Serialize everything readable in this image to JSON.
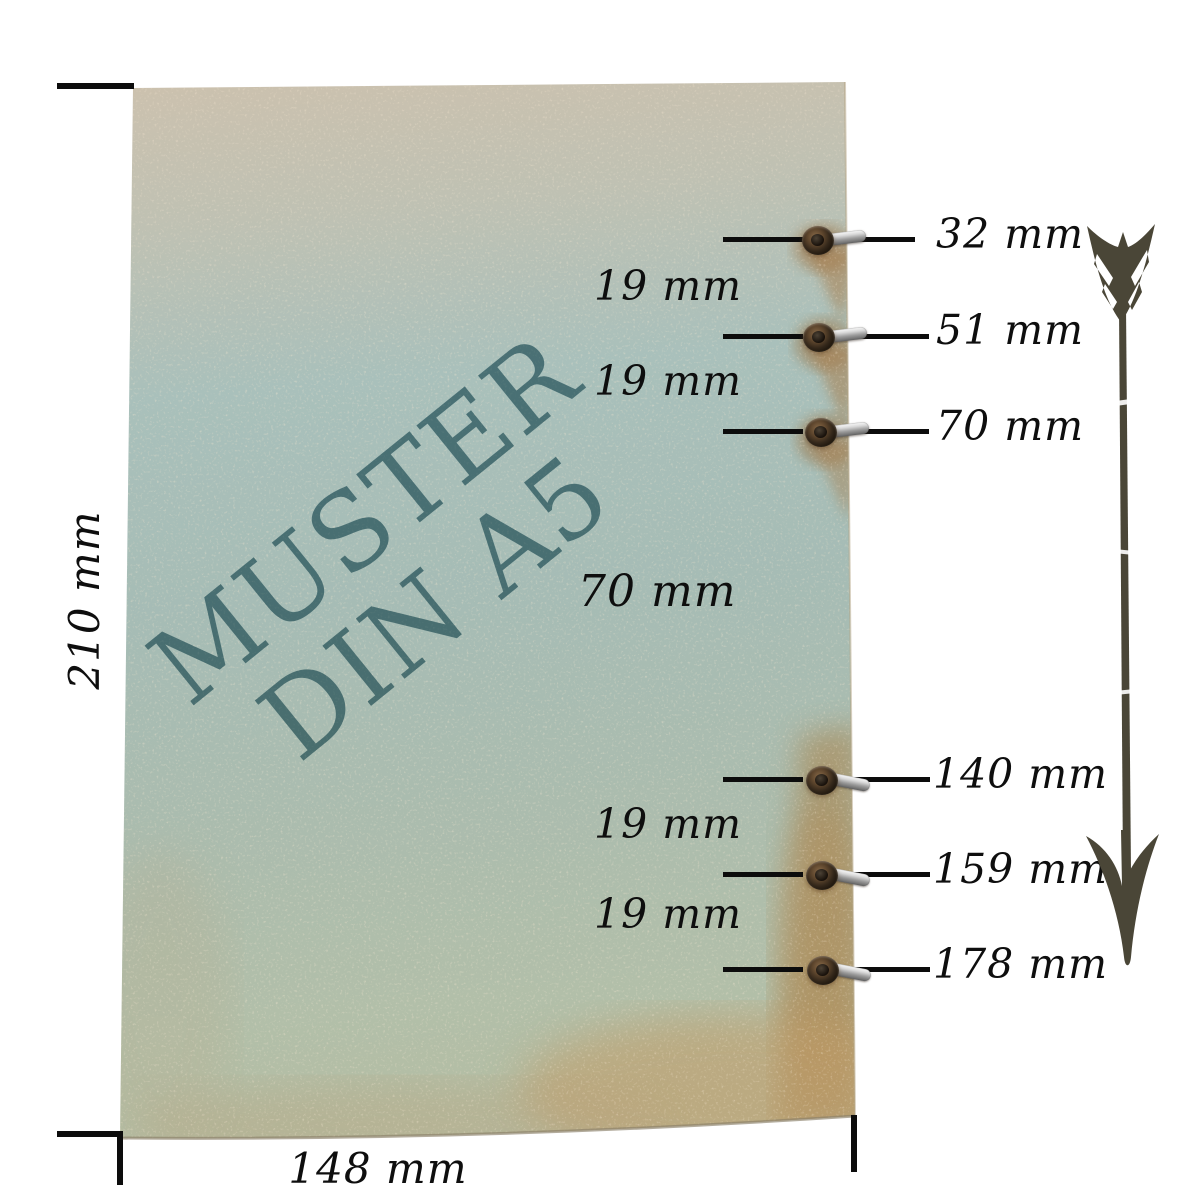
{
  "watermark": {
    "line1": "MUSTER",
    "line2": "DIN A5"
  },
  "sheet": {
    "height_label": "210 mm",
    "width_label": "148 mm"
  },
  "holes": [
    {
      "label": "32 mm"
    },
    {
      "label": "51 mm"
    },
    {
      "label": "70 mm"
    },
    {
      "label": "140 mm"
    },
    {
      "label": "159 mm"
    },
    {
      "label": "178 mm"
    }
  ],
  "spacings": [
    {
      "label": "19 mm"
    },
    {
      "label": "19 mm"
    },
    {
      "label": "70 mm"
    },
    {
      "label": "19 mm"
    },
    {
      "label": "19 mm"
    }
  ],
  "colors": {
    "paper_top_beige": "#cbc0ae",
    "paper_teal": "#a8bfba",
    "paper_sage": "#aebbae",
    "stain_brown": "#b08454",
    "watermark_teal": "#4e7d8a",
    "line_black": "#0c0c0c",
    "arrow_olive": "#4a4637",
    "eyelet_brown": "#5e462d",
    "metal_silver": "#c9c9c9"
  }
}
